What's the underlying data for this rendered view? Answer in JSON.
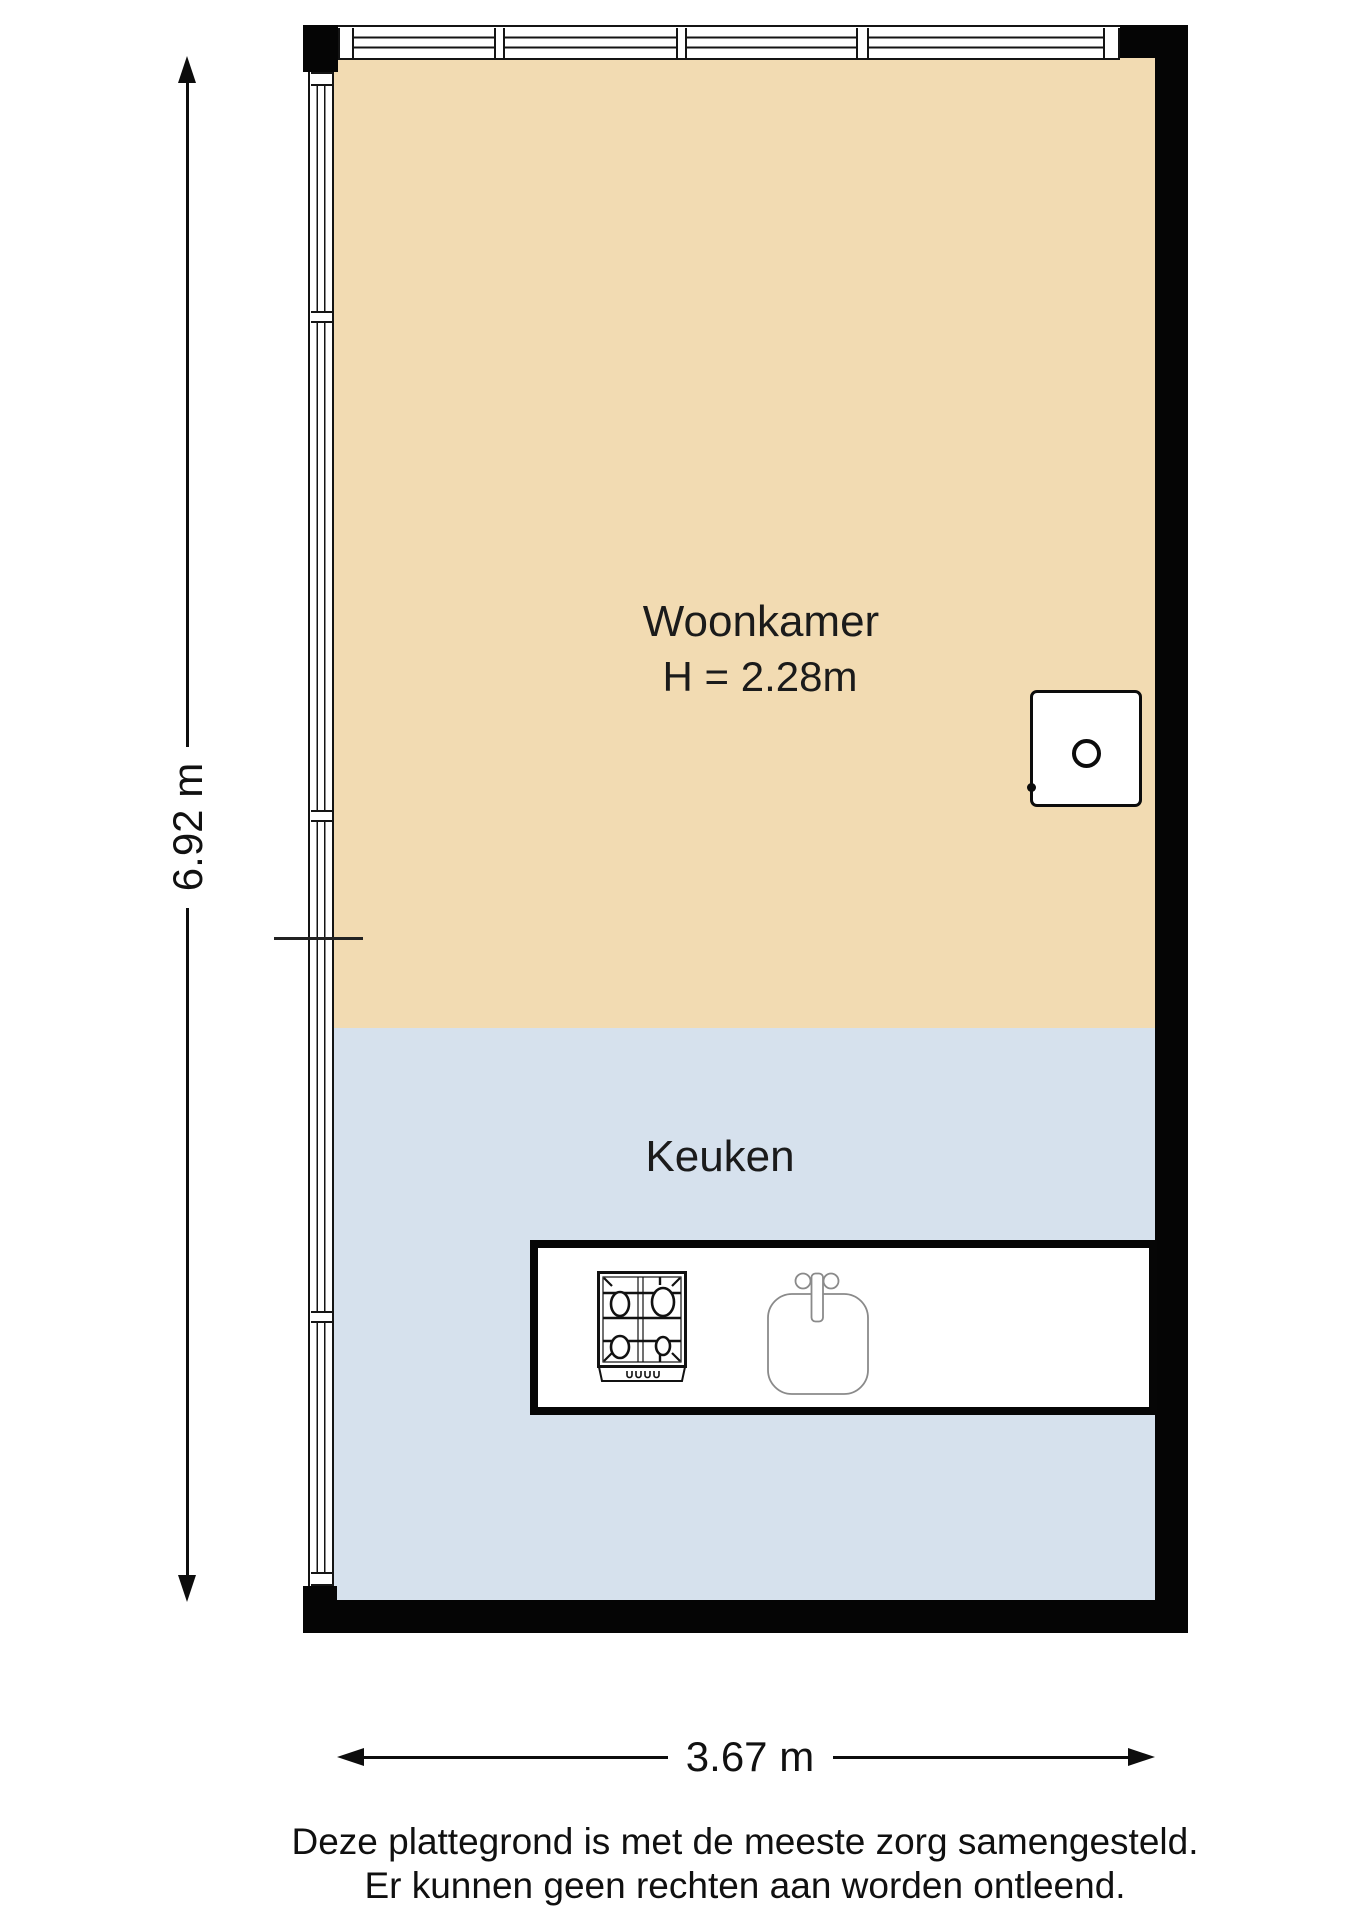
{
  "plan": {
    "rooms": {
      "woonkamer": {
        "label": "Woonkamer",
        "height_label": "H = 2.28m",
        "fill": "#F2DBB2"
      },
      "keuken": {
        "label": "Keuken",
        "fill": "#D6E1ED"
      }
    },
    "dimensions": {
      "vertical": "6.92 m",
      "horizontal": "3.67 m"
    },
    "fixtures": {
      "boiler": "boiler-unit",
      "counter": "kitchen-counter",
      "stove": "gas-hob-four-burners",
      "sink": "kitchen-sink-with-faucet"
    },
    "icons": {
      "stove": "stove-icon",
      "sink": "sink-icon",
      "boiler": "boiler-icon"
    },
    "colors": {
      "wall": "#050505",
      "line": "#141414",
      "woonkamer_fill": "#F2DBB2",
      "keuken_fill": "#D6E1ED",
      "fixture_outline": "#8A8A8A"
    }
  },
  "footer": {
    "line1": "Deze plattegrond is met de meeste zorg samengesteld.",
    "line2": "Er kunnen geen rechten aan worden ontleend."
  }
}
